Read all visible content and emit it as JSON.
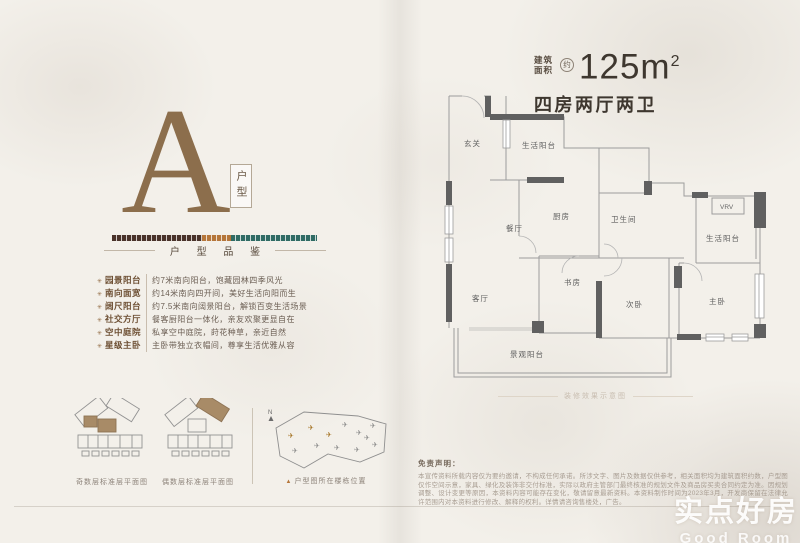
{
  "header": {
    "area_label_top": "建筑",
    "area_label_bottom": "面积",
    "approx": "约",
    "area_value": "125m",
    "area_sup": "2",
    "layout_title": "四房两厅两卫"
  },
  "left": {
    "letter": "A",
    "letter_tag": "户型",
    "section_title": "户 型 品 鉴",
    "features": [
      {
        "label": "园景阳台",
        "desc": "约7米南向阳台，饱藏园林四季风光"
      },
      {
        "label": "南向面宽",
        "desc": "约14米南向四开间，美好生活向阳而生"
      },
      {
        "label": "阔尺阳台",
        "desc": "约7.5米南向阔景阳台，解锁百变生活场景"
      },
      {
        "label": "社交方厅",
        "desc": "餐客厨阳台一体化，亲友欢聚更显自在"
      },
      {
        "label": "空中庭院",
        "desc": "私享空中庭院，莳花种草，亲近自然"
      },
      {
        "label": "星级主卧",
        "desc": "主卧带独立衣帽间，尊享生活优雅从容"
      }
    ],
    "diagram_captions": {
      "odd": "奇数层标准层平面图",
      "even": "偶数层标准层平面图",
      "site_marker": "▲",
      "site": "户型图所在楼栋位置",
      "compass": "N"
    }
  },
  "floorplan": {
    "rooms": [
      "玄关",
      "生活阳台",
      "厨房",
      "餐厅",
      "卫生间",
      "VRV",
      "生活阳台",
      "客厅",
      "书房",
      "次卧",
      "主卧",
      "景观阳台"
    ],
    "caption": "装修效果示意图"
  },
  "disclaimer": {
    "title": "免责声明：",
    "text": "本宣传资料所载内容仅为要约邀请，不构成任何承诺。所涉文字、图片及数据仅供参考，相关面积均为建筑面积约数，户型图仅作空间示意，家具、绿化及装饰非交付标准，实际以政府主管部门最终核准的规划文件及商品房买卖合同约定为准。因规划调整、设计变更等原因，本资料内容可能存在变化，敬请留意最新资料。本资料制作时间为2023年3月，开发商保留在法律允许范围内对本资料进行修改、解释的权利。详情请咨询售楼处，广告。"
  },
  "watermark": {
    "cn": "实点好房",
    "en": "Good Room"
  },
  "colors": {
    "letter_brown": "#8c6e4c",
    "bar_brown": "#4a332a",
    "bar_copper": "#b5763a",
    "bar_teal": "#2f6b64",
    "wall_dark": "#606060",
    "highlight_unit": "#a88b67"
  }
}
